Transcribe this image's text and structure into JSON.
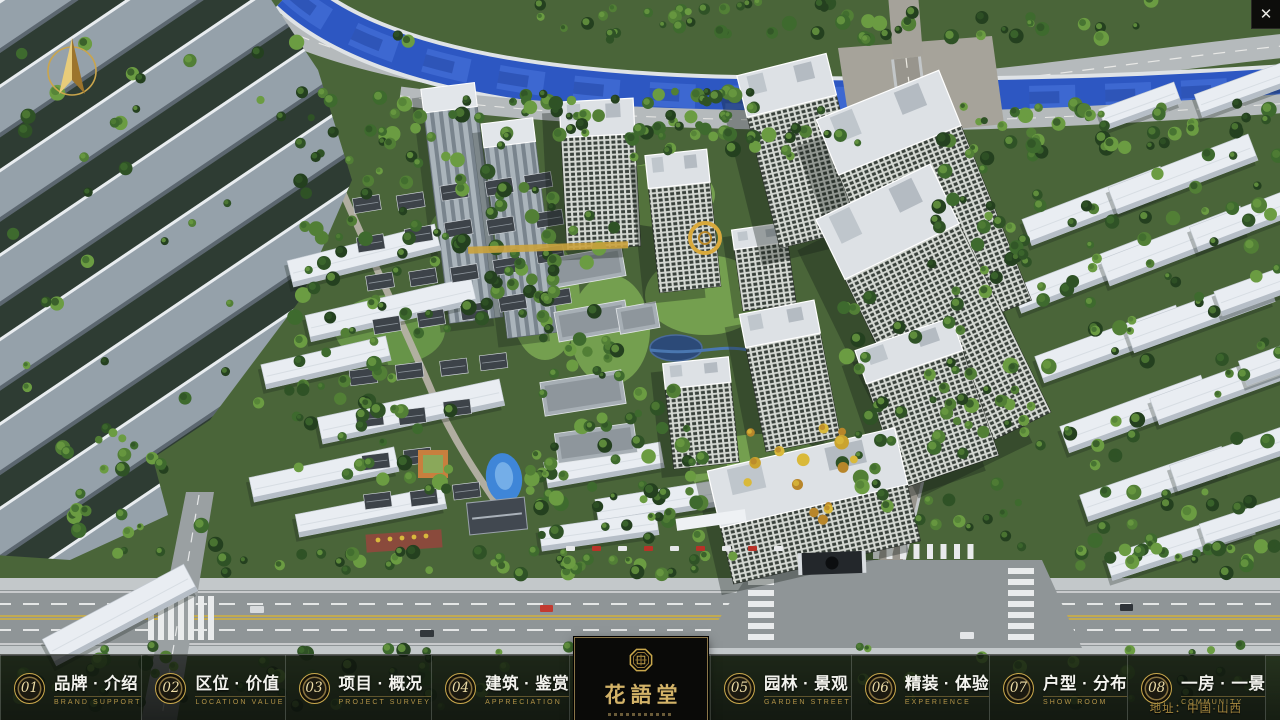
{
  "window": {
    "close_label": "✕"
  },
  "nav": {
    "items": [
      {
        "num": "01",
        "title": "品牌 · 介绍",
        "subtitle": "BRAND SUPPORT"
      },
      {
        "num": "02",
        "title": "区位 · 价值",
        "subtitle": "LOCATION VALUE"
      },
      {
        "num": "03",
        "title": "项目 · 概况",
        "subtitle": "PROJECT SURVEY"
      },
      {
        "num": "04",
        "title": "建筑 · 鉴赏",
        "subtitle": "APPRECIATION"
      },
      {
        "num": "05",
        "title": "园林 · 景观",
        "subtitle": "GARDEN STREET"
      },
      {
        "num": "06",
        "title": "精装 · 体验",
        "subtitle": "EXPERIENCE"
      },
      {
        "num": "07",
        "title": "户型 · 分布",
        "subtitle": "SHOW ROOM"
      },
      {
        "num": "08",
        "title": "一房 · 一景",
        "subtitle": "COMMUNITY"
      }
    ]
  },
  "logo": {
    "name": "花語堂"
  },
  "footer": {
    "address": "地址：中国·山西"
  },
  "theme": {
    "accent_gold": "#c9a84c",
    "gold_dim": "#a8893f",
    "river_blue": "#2d57c2",
    "tree_green": "#3e6a2e",
    "bar_background": "rgba(8,10,8,0.70)"
  }
}
